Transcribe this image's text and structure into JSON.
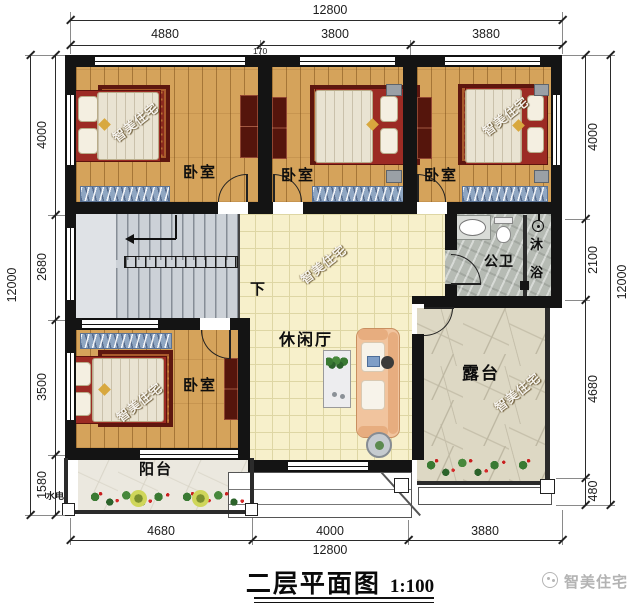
{
  "plan": {
    "watermark_text": "智美住宅",
    "labels": {
      "bedroom_top_left": "卧室",
      "bedroom_top_middle": "卧室",
      "bedroom_top_right": "卧室",
      "bedroom_bottom_left": "卧室",
      "leisure_hall": "休闲厅",
      "bathroom": "公卫",
      "shower_char_1": "沐",
      "shower_char_2": "浴",
      "stairs_down": "下",
      "balcony": "阳台",
      "terrace": "露台",
      "utility_note": "水电"
    }
  },
  "dimensions": {
    "top": {
      "overall": "12800",
      "seg1": "4880",
      "seg2": "3800",
      "seg3": "3880",
      "minor": "170"
    },
    "bottom": {
      "overall": "12800",
      "seg1": "4680",
      "seg2": "4000",
      "seg3": "3880"
    },
    "left": {
      "overall": "12000",
      "seg1": "4000",
      "seg2": "2680",
      "seg3": "3500",
      "seg4": "1580"
    },
    "right": {
      "overall": "12000",
      "seg1": "4000",
      "seg2": "2100",
      "seg3": "4680",
      "seg4": "480"
    }
  },
  "footer": {
    "title": "二层平面图",
    "scale": "1:100",
    "brand": "智美住宅"
  },
  "palette": {
    "wall": "#141414",
    "wood_floor": "#d5a35b",
    "hall_tile": "#f7f0cb",
    "stair_gray": "#ccd1d7",
    "bath_stone": "#b6bbb4",
    "terrace_stone": "#ddd8c4",
    "bed_frame_red": "#9c2b24",
    "rug_red": "#8a2a1e",
    "wardrobe_maroon": "#55150c",
    "rug_blue": "#8fa6c2",
    "sofa_peach": "#f1c49e",
    "flower_red": "#c81f1f",
    "plant_green": "#3a7a33"
  }
}
